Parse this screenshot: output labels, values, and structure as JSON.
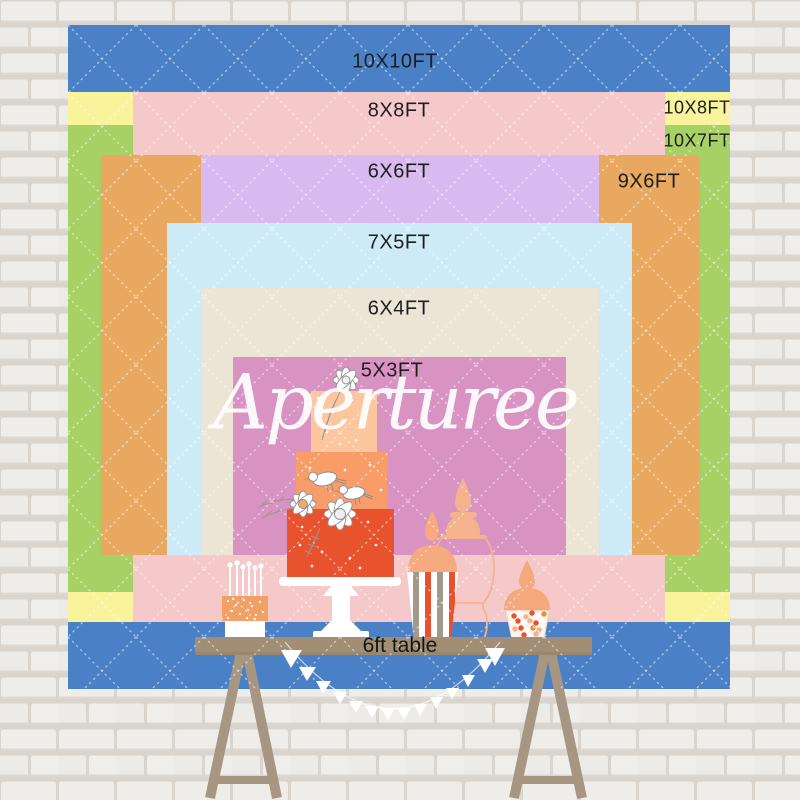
{
  "backdrop": {
    "brand_watermark": "Aperturee",
    "table_label": "6ft table",
    "label_color": "#1e1e1e",
    "quilt_line_color": "#ffffff",
    "sizes": [
      {
        "id": "10x10ft",
        "label": "10X10FT",
        "color": "#4a80c6"
      },
      {
        "id": "10x8ft",
        "label": "10X8FT",
        "color": "#f9f39c"
      },
      {
        "id": "10x7ft",
        "label": "10X7FT",
        "color": "#a7d065"
      },
      {
        "id": "8x8ft",
        "label": "8X8FT",
        "color": "#f5c8ca"
      },
      {
        "id": "9x6ft",
        "label": "9X6FT",
        "color": "#e9a85f"
      },
      {
        "id": "6x6ft",
        "label": "6X6FT",
        "color": "#d9baf0"
      },
      {
        "id": "7x5ft",
        "label": "7X5FT",
        "color": "#cdebf7"
      },
      {
        "id": "6x4ft",
        "label": "6X4FT",
        "color": "#ece4d5"
      },
      {
        "id": "5x3ft",
        "label": "5X3FT",
        "color": "#d893c3"
      }
    ],
    "palette": {
      "table_wood": "#a28e74",
      "cake_dark_orange": "#e8532d",
      "cake_mid_orange": "#f89c68",
      "cake_light_peach": "#fcc79f",
      "prop_peach": "#f5ab7f",
      "bunting_white": "#ffffff"
    }
  }
}
